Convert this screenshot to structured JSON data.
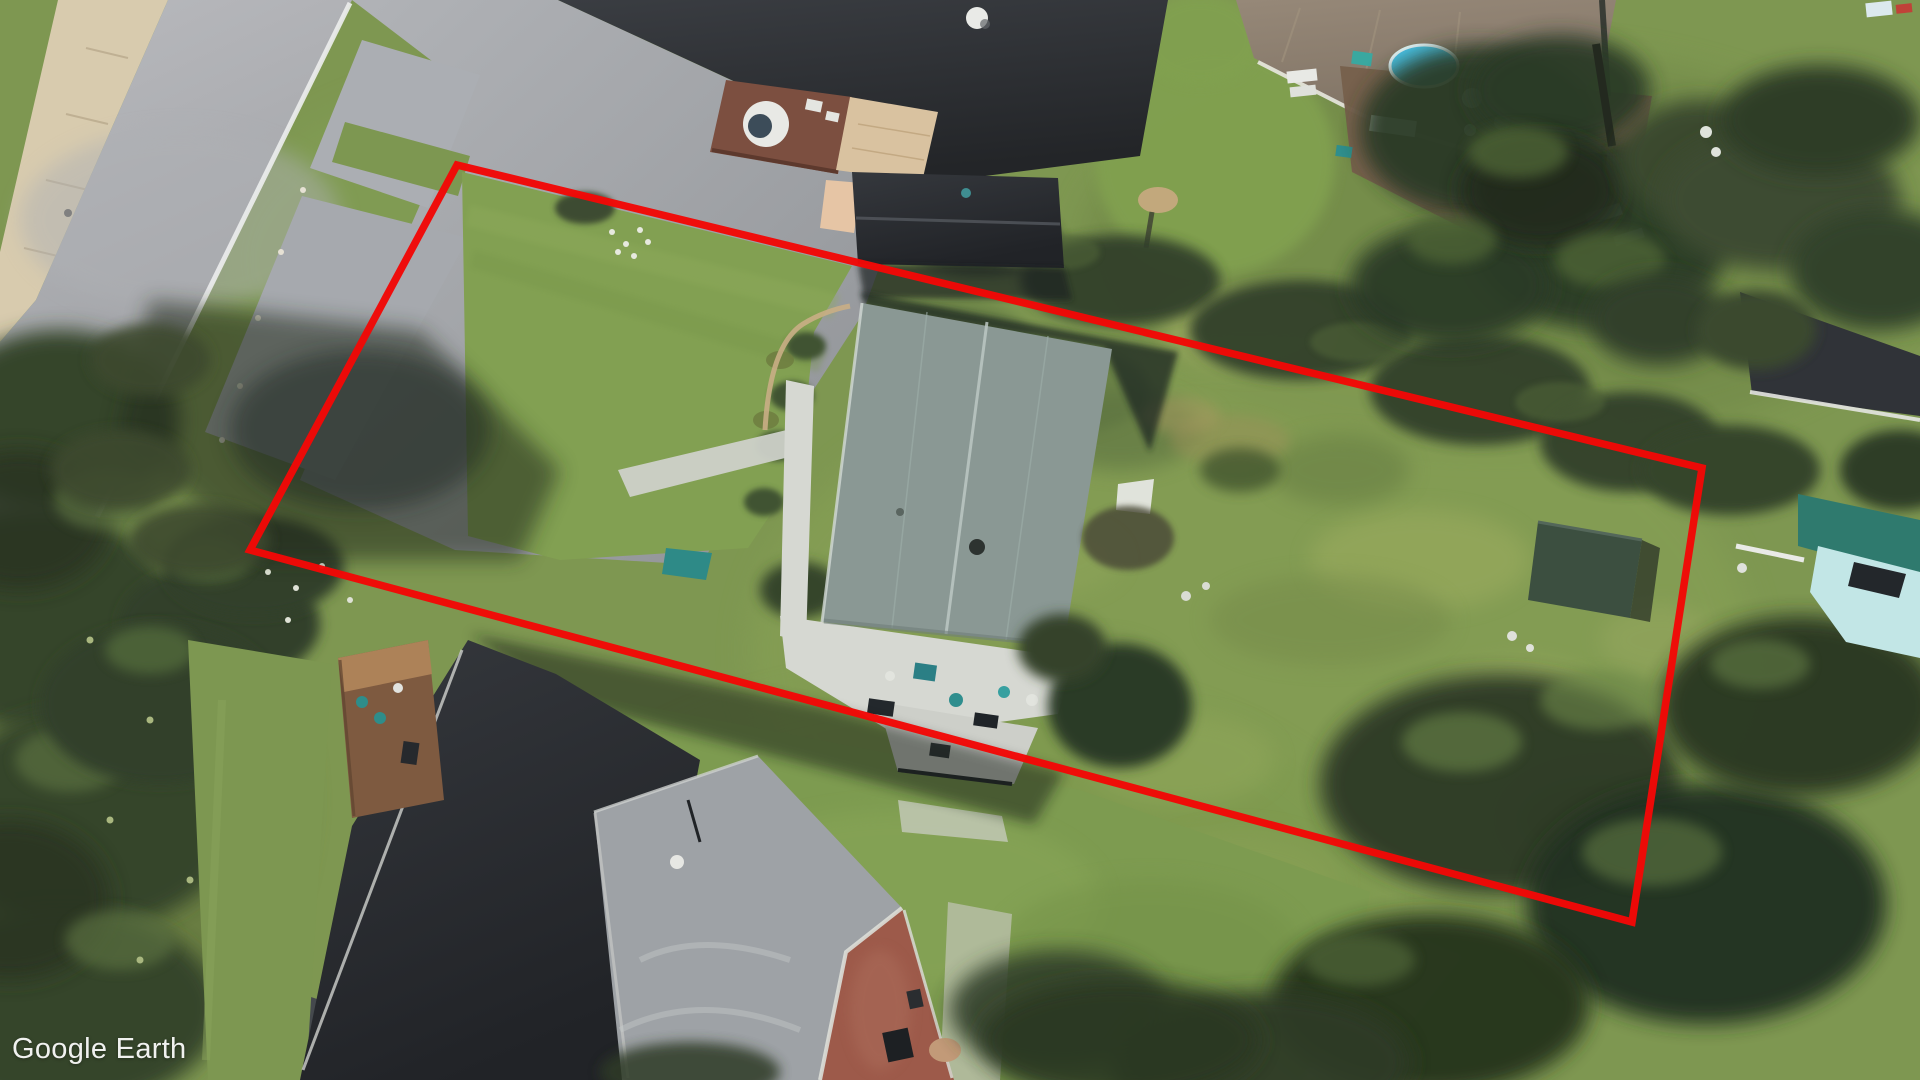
{
  "watermark": {
    "text": "Google Earth"
  },
  "annotation": {
    "name": "property-boundary",
    "color": "#f20806",
    "stroke_width": 7.5,
    "points": "457,165 1702,468 1632,922 250,550"
  },
  "palette": {
    "accent_red": "#f20806",
    "lawn": "#7e9751",
    "sidewalk": "#d8cbae",
    "road_asphalt": "#a7a9ad",
    "deck_white": "#d6d8d2",
    "subject_roof": "#8a9894",
    "dark_roof": "#303338",
    "taupe_roof": "#8b7d6e",
    "rust_roof": "#9d5a4a",
    "pool_blue": "#49c3e6",
    "shed_green": "#3c4f40",
    "boat_teal": "#c2e6e6",
    "tree_dark": "#2d3a26"
  },
  "scene": {
    "type": "oblique-aerial-photo",
    "features": [
      "street-with-sidewalk",
      "gravel-parking-pads",
      "front-lawn",
      "teal-gray-roof-house-with-white-deck",
      "overgrown-back-lot",
      "dark-green-garden-shed",
      "neighbor-houses",
      "backyard-pool",
      "tree-shadow",
      "red-parcel-outline"
    ]
  }
}
